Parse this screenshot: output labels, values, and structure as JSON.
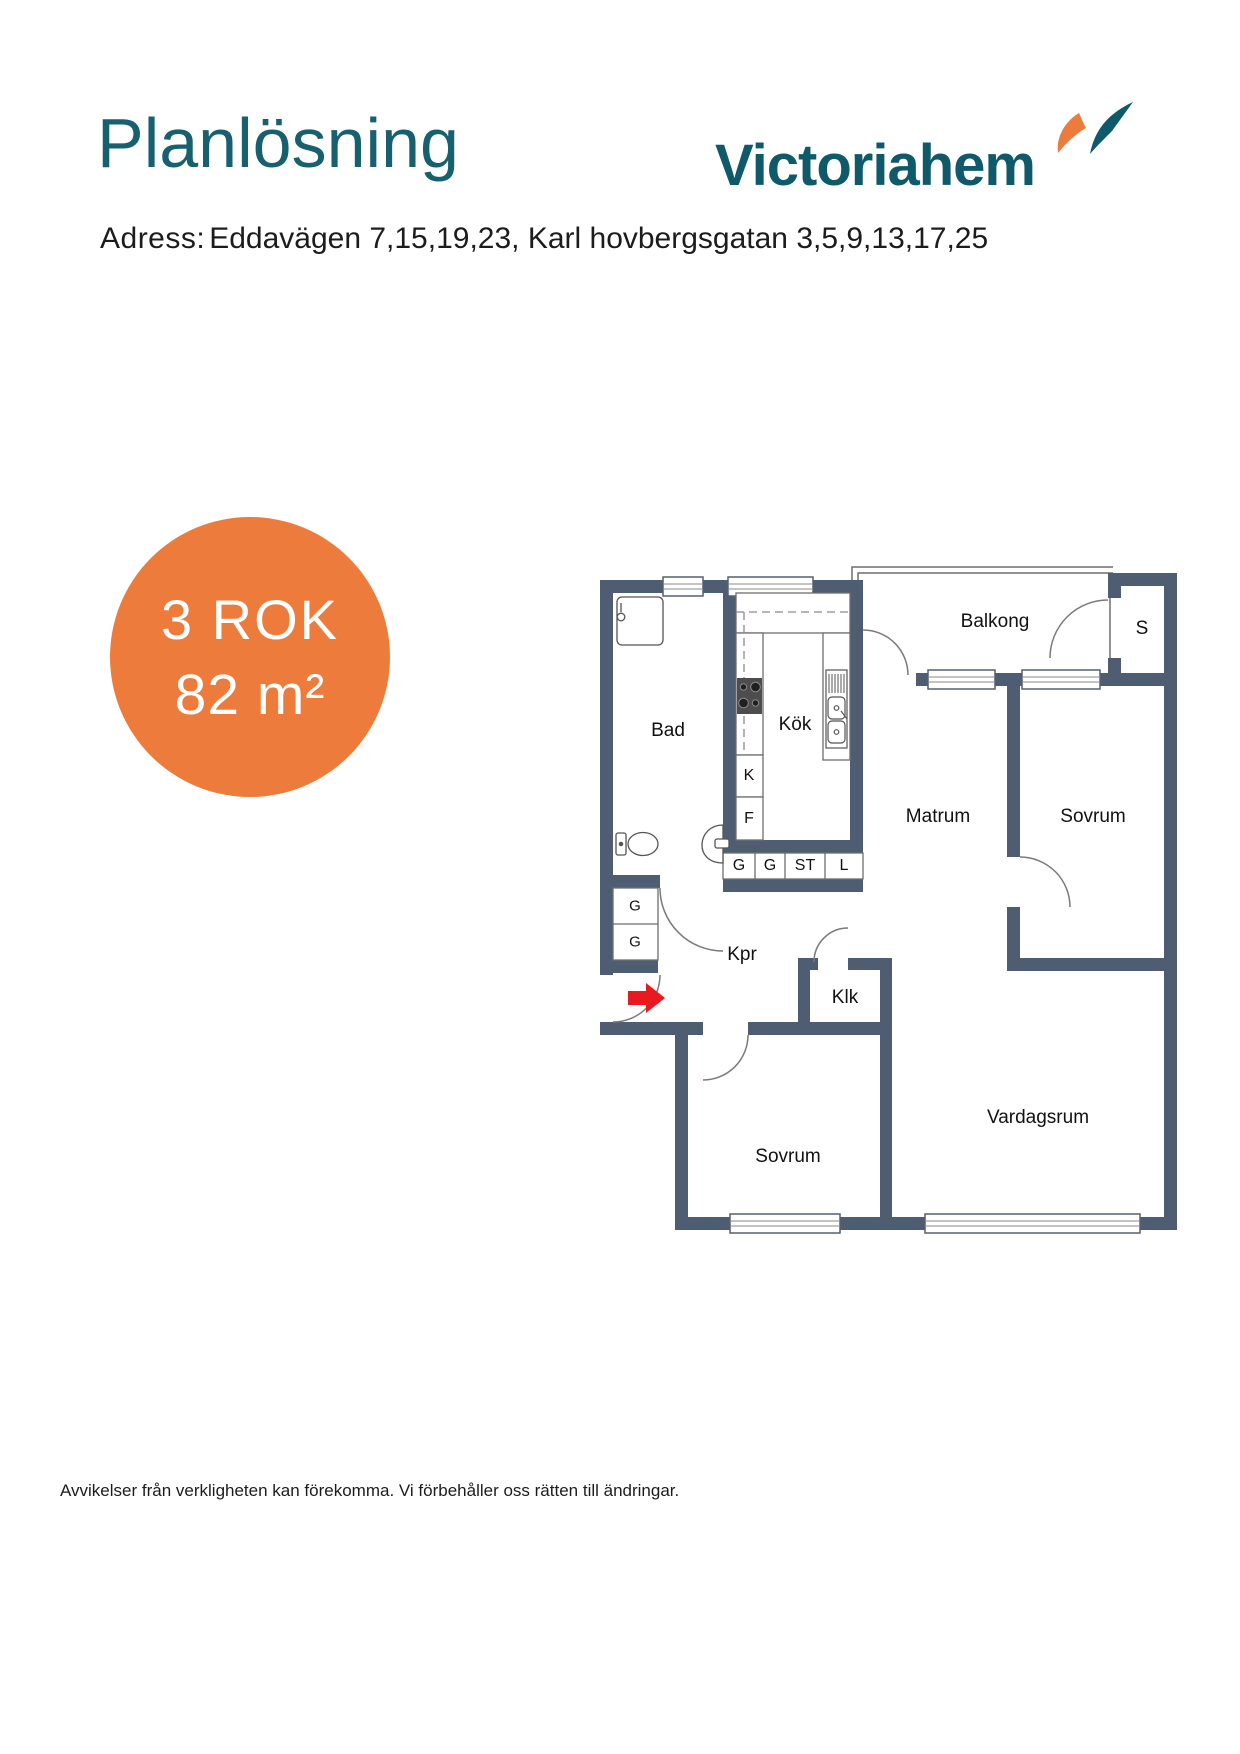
{
  "header": {
    "title": "Planlösning",
    "brand": "Victoriahem"
  },
  "address": {
    "label": "Adress:",
    "value": "Eddavägen 7,15,19,23, Karl hovbergsgatan 3,5,9,13,17,25"
  },
  "badge": {
    "rooms": "3 ROK",
    "area": "82 m²"
  },
  "floorplan": {
    "rooms": [
      {
        "text": "Balkong",
        "x": 995,
        "y": 622,
        "size": 19
      },
      {
        "text": "S",
        "x": 1142,
        "y": 629,
        "size": 19
      },
      {
        "text": "Bad",
        "x": 668,
        "y": 731,
        "size": 19
      },
      {
        "text": "Kök",
        "x": 795,
        "y": 725,
        "size": 19
      },
      {
        "text": "K",
        "x": 749,
        "y": 776,
        "size": 16
      },
      {
        "text": "F",
        "x": 749,
        "y": 819,
        "size": 16
      },
      {
        "text": "G",
        "x": 739,
        "y": 866,
        "size": 16
      },
      {
        "text": "G",
        "x": 770,
        "y": 866,
        "size": 16
      },
      {
        "text": "ST",
        "x": 805,
        "y": 866,
        "size": 16
      },
      {
        "text": "L",
        "x": 844,
        "y": 866,
        "size": 16
      },
      {
        "text": "Matrum",
        "x": 938,
        "y": 817,
        "size": 19
      },
      {
        "text": "Sovrum",
        "x": 1093,
        "y": 817,
        "size": 19
      },
      {
        "text": "G",
        "x": 635,
        "y": 906,
        "size": 15
      },
      {
        "text": "G",
        "x": 635,
        "y": 942,
        "size": 15
      },
      {
        "text": "Kpr",
        "x": 742,
        "y": 955,
        "size": 19
      },
      {
        "text": "Klk",
        "x": 845,
        "y": 998,
        "size": 19
      },
      {
        "text": "Sovrum",
        "x": 788,
        "y": 1157,
        "size": 19
      },
      {
        "text": "Vardagsrum",
        "x": 1038,
        "y": 1118,
        "size": 19
      }
    ]
  },
  "footer": {
    "disclaimer": "Avvikelser från verkligheten kan förekomma. Vi förbehåller oss rätten till ändringar."
  },
  "colors": {
    "accent_teal": "#16606F",
    "brand_teal": "#0E5A6B",
    "brand_orange": "#ED7B3B",
    "wall": "#4E5D72",
    "entry_arrow": "#E8191F"
  }
}
